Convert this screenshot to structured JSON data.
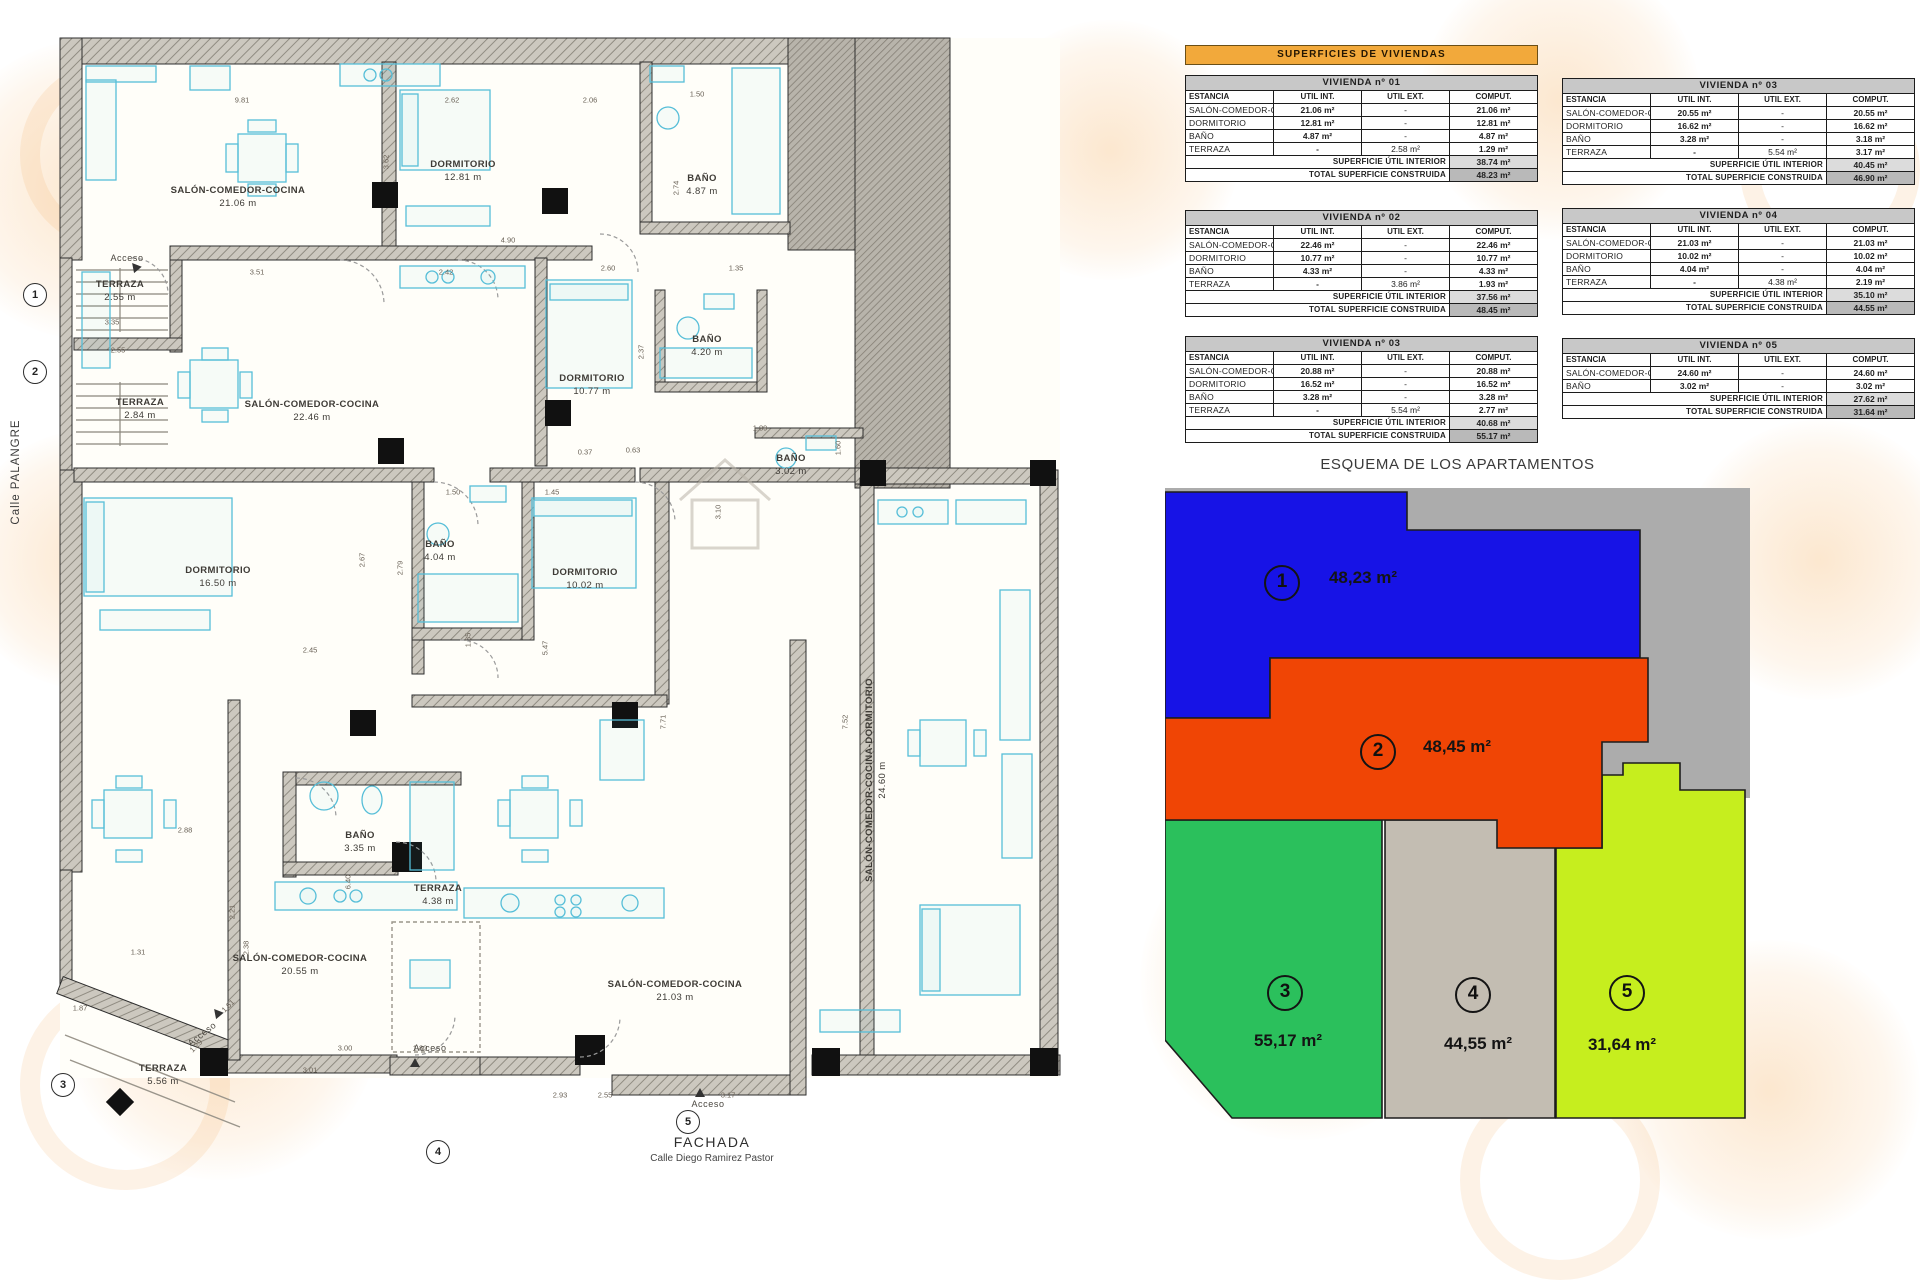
{
  "banner": {
    "title": "SUPERFICIES DE VIVIENDAS"
  },
  "tables": [
    {
      "title": "VIVIENDA nº 01",
      "headers": [
        "ESTANCIA",
        "UTIL INT.",
        "UTIL EXT.",
        "COMPUT."
      ],
      "rows": [
        [
          "SALÓN-COMEDOR-COCINA",
          "21.06 m²",
          "-",
          "21.06 m²"
        ],
        [
          "DORMITORIO",
          "12.81 m²",
          "-",
          "12.81 m²"
        ],
        [
          "BAÑO",
          "4.87 m²",
          "-",
          "4.87 m²"
        ],
        [
          "TERRAZA",
          "-",
          "2.58 m²",
          "1.29 m²"
        ]
      ],
      "summary": [
        [
          "SUPERFICIE ÚTIL INTERIOR",
          "38.74 m²"
        ],
        [
          "TOTAL SUPERFICIE CONSTRUIDA",
          "48.23 m²"
        ]
      ]
    },
    {
      "title": "VIVIENDA nº 02",
      "headers": [
        "ESTANCIA",
        "UTIL INT.",
        "UTIL EXT.",
        "COMPUT."
      ],
      "rows": [
        [
          "SALÓN-COMEDOR-COCINA",
          "22.46 m²",
          "-",
          "22.46 m²"
        ],
        [
          "DORMITORIO",
          "10.77 m²",
          "-",
          "10.77 m²"
        ],
        [
          "BAÑO",
          "4.33 m²",
          "-",
          "4.33 m²"
        ],
        [
          "TERRAZA",
          "-",
          "3.86 m²",
          "1.93 m²"
        ]
      ],
      "summary": [
        [
          "SUPERFICIE ÚTIL INTERIOR",
          "37.56 m²"
        ],
        [
          "TOTAL SUPERFICIE CONSTRUIDA",
          "48.45 m²"
        ]
      ]
    },
    {
      "title": "VIVIENDA nº 03",
      "headers": [
        "ESTANCIA",
        "UTIL INT.",
        "UTIL EXT.",
        "COMPUT."
      ],
      "rows": [
        [
          "SALÓN-COMEDOR-COCINA",
          "20.88 m²",
          "-",
          "20.88 m²"
        ],
        [
          "DORMITORIO",
          "16.52 m²",
          "-",
          "16.52 m²"
        ],
        [
          "BAÑO",
          "3.28 m²",
          "-",
          "3.28 m²"
        ],
        [
          "TERRAZA",
          "-",
          "5.54 m²",
          "2.77 m²"
        ]
      ],
      "summary": [
        [
          "SUPERFICIE ÚTIL INTERIOR",
          "40.68 m²"
        ],
        [
          "TOTAL SUPERFICIE CONSTRUIDA",
          "55.17 m²"
        ]
      ]
    },
    {
      "title": "VIVIENDA nº 03",
      "headers": [
        "ESTANCIA",
        "UTIL INT.",
        "UTIL EXT.",
        "COMPUT."
      ],
      "rows": [
        [
          "SALÓN-COMEDOR-COCINA",
          "20.55 m²",
          "-",
          "20.55 m²"
        ],
        [
          "DORMITORIO",
          "16.62 m²",
          "-",
          "16.62 m²"
        ],
        [
          "BAÑO",
          "3.28 m²",
          "-",
          "3.18 m²"
        ],
        [
          "TERRAZA",
          "-",
          "5.54 m²",
          "3.17 m²"
        ]
      ],
      "summary": [
        [
          "SUPERFICIE ÚTIL INTERIOR",
          "40.45 m²"
        ],
        [
          "TOTAL SUPERFICIE CONSTRUIDA",
          "46.90 m²"
        ]
      ]
    },
    {
      "title": "VIVIENDA nº 04",
      "headers": [
        "ESTANCIA",
        "UTIL INT.",
        "UTIL EXT.",
        "COMPUT."
      ],
      "rows": [
        [
          "SALÓN-COMEDOR-COCINA",
          "21.03 m²",
          "-",
          "21.03 m²"
        ],
        [
          "DORMITORIO",
          "10.02 m²",
          "-",
          "10.02 m²"
        ],
        [
          "BAÑO",
          "4.04 m²",
          "-",
          "4.04 m²"
        ],
        [
          "TERRAZA",
          "-",
          "4.38 m²",
          "2.19 m²"
        ]
      ],
      "summary": [
        [
          "SUPERFICIE ÚTIL INTERIOR",
          "35.10 m²"
        ],
        [
          "TOTAL SUPERFICIE CONSTRUIDA",
          "44.55 m²"
        ]
      ]
    },
    {
      "title": "VIVIENDA nº 05",
      "headers": [
        "ESTANCIA",
        "UTIL INT.",
        "UTIL EXT.",
        "COMPUT."
      ],
      "rows": [
        [
          "SALÓN-COMEDOR-COCINA-DORMITORIO",
          "24.60 m²",
          "-",
          "24.60 m²"
        ],
        [
          "BAÑO",
          "3.02 m²",
          "-",
          "3.02 m²"
        ]
      ],
      "summary": [
        [
          "SUPERFICIE ÚTIL INTERIOR",
          "27.62 m²"
        ],
        [
          "TOTAL SUPERFICIE CONSTRUIDA",
          "31.64 m²"
        ]
      ]
    }
  ],
  "schematic": {
    "title": "ESQUEMA DE LOS APARTAMENTOS",
    "apartments": [
      {
        "num": "1",
        "area": "48,23 m²",
        "color": "#1713e6"
      },
      {
        "num": "2",
        "area": "48,45 m²",
        "color": "#f04505"
      },
      {
        "num": "3",
        "area": "55,17 m²",
        "color": "#2bc05c"
      },
      {
        "num": "4",
        "area": "44,55 m²",
        "color": "#c3bdb2"
      },
      {
        "num": "5",
        "area": "31,64 m²",
        "color": "#c6ee1e"
      }
    ]
  },
  "plan": {
    "street_label": "Calle PALANGRE",
    "facade_label": "FACHADA",
    "facade_sub": "Calle Diego Ramirez Pastor",
    "access_label": "Acceso",
    "rooms": [
      {
        "n": "SALÓN-COMEDOR-COCINA",
        "a": "21.06 m",
        "x": 238,
        "y": 198
      },
      {
        "n": "DORMITORIO",
        "a": "12.81 m",
        "x": 463,
        "y": 172
      },
      {
        "n": "BAÑO",
        "a": "4.87 m",
        "x": 702,
        "y": 186
      },
      {
        "n": "TERRAZA",
        "a": "2.55 m",
        "x": 120,
        "y": 292
      },
      {
        "n": "TERRAZA",
        "a": "2.84 m",
        "x": 140,
        "y": 410
      },
      {
        "n": "SALÓN-COMEDOR-COCINA",
        "a": "22.46 m",
        "x": 312,
        "y": 412
      },
      {
        "n": "DORMITORIO",
        "a": "10.77 m",
        "x": 592,
        "y": 386
      },
      {
        "n": "BAÑO",
        "a": "4.20 m",
        "x": 707,
        "y": 347
      },
      {
        "n": "BAÑO",
        "a": "3.02 m",
        "x": 791,
        "y": 466
      },
      {
        "n": "DORMITORIO",
        "a": "16.50 m",
        "x": 218,
        "y": 578
      },
      {
        "n": "BAÑO",
        "a": "4.04 m",
        "x": 440,
        "y": 552
      },
      {
        "n": "DORMITORIO",
        "a": "10.02 m",
        "x": 585,
        "y": 580
      },
      {
        "n": "BAÑO",
        "a": "3.35 m",
        "x": 360,
        "y": 843
      },
      {
        "n": "SALÓN-COMEDOR-COCINA",
        "a": "20.55 m",
        "x": 300,
        "y": 966
      },
      {
        "n": "SALÓN-COMEDOR-COCINA",
        "a": "21.03 m",
        "x": 675,
        "y": 992
      },
      {
        "n": "TERRAZA",
        "a": "5.56 m",
        "x": 163,
        "y": 1076
      },
      {
        "n": "TERRAZA",
        "a": "4.38 m",
        "x": 438,
        "y": 896
      },
      {
        "n": "SALÓN-COMEDOR-COCINA-DORMITORIO",
        "a": "24.60 m",
        "x": 877,
        "y": 780,
        "v": 1
      }
    ],
    "dims": [
      {
        "t": "9.81",
        "x": 242,
        "y": 100
      },
      {
        "t": "2.62",
        "x": 452,
        "y": 100
      },
      {
        "t": "2.06",
        "x": 590,
        "y": 100
      },
      {
        "t": "1.50",
        "x": 697,
        "y": 94
      },
      {
        "t": "3.62",
        "x": 386,
        "y": 162,
        "r": -90
      },
      {
        "t": "2.74",
        "x": 676,
        "y": 188,
        "r": -90
      },
      {
        "t": "4.90",
        "x": 508,
        "y": 240
      },
      {
        "t": "1.35",
        "x": 736,
        "y": 268
      },
      {
        "t": "3.51",
        "x": 257,
        "y": 272
      },
      {
        "t": "2.42",
        "x": 446,
        "y": 272
      },
      {
        "t": "2.60",
        "x": 608,
        "y": 268
      },
      {
        "t": "3.35",
        "x": 112,
        "y": 322
      },
      {
        "t": "2.55",
        "x": 118,
        "y": 350
      },
      {
        "t": "2.37",
        "x": 641,
        "y": 352,
        "r": -90
      },
      {
        "t": "0.37",
        "x": 585,
        "y": 452
      },
      {
        "t": "0.63",
        "x": 633,
        "y": 450
      },
      {
        "t": "1.89",
        "x": 760,
        "y": 428
      },
      {
        "t": "1.60",
        "x": 838,
        "y": 448,
        "r": -90
      },
      {
        "t": "1.50",
        "x": 453,
        "y": 492
      },
      {
        "t": "1.45",
        "x": 552,
        "y": 492
      },
      {
        "t": "3.10",
        "x": 718,
        "y": 512,
        "r": -90
      },
      {
        "t": "2.67",
        "x": 362,
        "y": 560,
        "r": -90
      },
      {
        "t": "2.79",
        "x": 400,
        "y": 568,
        "r": -90
      },
      {
        "t": "1.35",
        "x": 468,
        "y": 640,
        "r": -90
      },
      {
        "t": "5.47",
        "x": 545,
        "y": 648,
        "r": -90
      },
      {
        "t": "2.45",
        "x": 310,
        "y": 650
      },
      {
        "t": "2.88",
        "x": 185,
        "y": 830
      },
      {
        "t": "7.71",
        "x": 663,
        "y": 722,
        "r": -90
      },
      {
        "t": "7.52",
        "x": 845,
        "y": 722,
        "r": -90
      },
      {
        "t": "2.21",
        "x": 232,
        "y": 912,
        "r": -90
      },
      {
        "t": "2.38",
        "x": 246,
        "y": 948,
        "r": -90
      },
      {
        "t": "6.40",
        "x": 348,
        "y": 882,
        "r": -90
      },
      {
        "t": "1.31",
        "x": 138,
        "y": 952
      },
      {
        "t": "1.87",
        "x": 80,
        "y": 1008
      },
      {
        "t": "1.61",
        "x": 228,
        "y": 1006,
        "r": -45
      },
      {
        "t": "1.29",
        "x": 196,
        "y": 1046,
        "r": -45
      },
      {
        "t": "3.00",
        "x": 345,
        "y": 1048
      },
      {
        "t": "1.80",
        "x": 420,
        "y": 1048
      },
      {
        "t": "3.01",
        "x": 310,
        "y": 1070
      },
      {
        "t": "2.93",
        "x": 560,
        "y": 1095
      },
      {
        "t": "2.55",
        "x": 605,
        "y": 1095
      },
      {
        "t": "3.17",
        "x": 728,
        "y": 1095
      }
    ],
    "markers": [
      {
        "n": "1",
        "x": 35,
        "y": 295
      },
      {
        "n": "2",
        "x": 35,
        "y": 372
      },
      {
        "n": "3",
        "x": 63,
        "y": 1085
      },
      {
        "n": "4",
        "x": 438,
        "y": 1152
      },
      {
        "n": "5",
        "x": 688,
        "y": 1122
      }
    ],
    "access_points": [
      {
        "x": 127,
        "y": 258
      },
      {
        "x": 202,
        "y": 1034,
        "r": -38
      },
      {
        "x": 430,
        "y": 1048
      },
      {
        "x": 708,
        "y": 1104
      }
    ]
  }
}
